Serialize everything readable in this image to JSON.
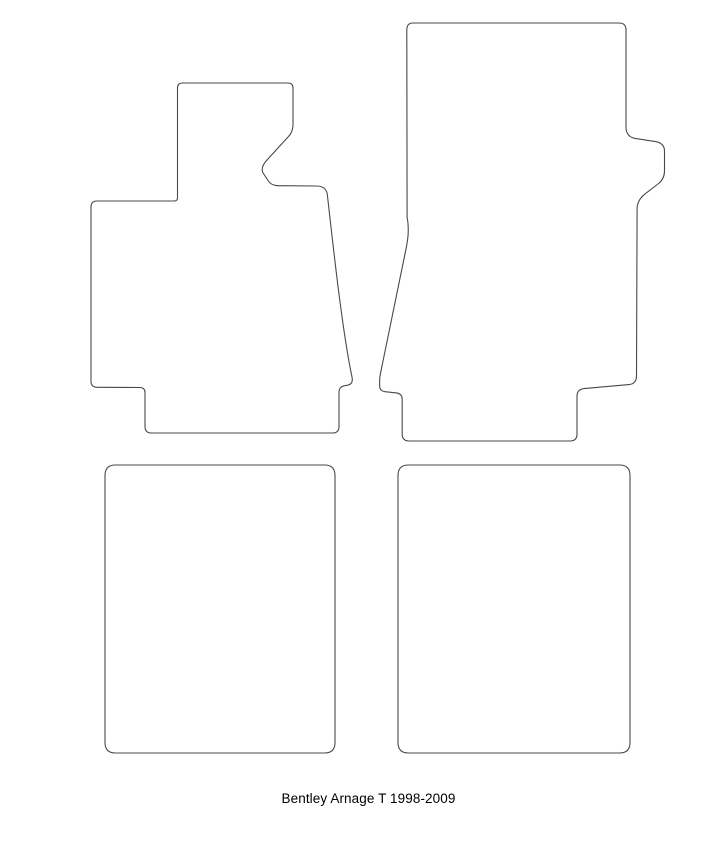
{
  "page": {
    "background_color": "#ffffff",
    "kind": "car floor mat template diagram"
  },
  "caption": {
    "text": "Bentley Arnage T 1998-2009",
    "color": "#000000"
  },
  "diagram": {
    "stroke_color": "#484848",
    "stroke_width": 1.1,
    "shapes": [
      {
        "name": "front-left-driver-mat-outline",
        "d": "M 182.5 83 L 288 83 Q 293 83 293 88 L 293 124 Q 293 132 288.5 136.5 L 267 160 Q 260.5 167 262.8 172.5 L 268 180.5 Q 271 185.5 278 185.7 L 317 186 Q 325.5 186.3 327.2 193.5 C 332.5 240 342 330 352 377 Q 353.5 384 347.5 385.2 L 344 385.8 Q 339 386.8 339 392.2 L 339 426.5 Q 339 433 332.5 433 L 151.5 433 Q 145 433 145 426.5 L 145 392.5 Q 145 387.8 140 387.5 L 97 387.3 Q 91 387.3 91 381.3 L 91 207 Q 91 201 97 201 L 174.5 201 Q 177.5 201 177.5 197.5 L 177.5 88 Q 177.5 83 182.5 83 Z"
      },
      {
        "name": "front-right-passenger-mat-outline",
        "d": "M 413 23 L 619 23 Q 626 23 626 30 L 626 128 Q 626.6 136.8 635 138.4 L 655.5 141.6 Q 664.5 143.2 664.5 151.2 L 664.5 171 Q 664.5 179 658 184 L 645.5 193.6 Q 637.2 200 637.1 208.5 L 636.5 376 Q 636.4 383.8 629 384.6 L 584 388.6 Q 577 389.4 577 396.4 L 577 434 Q 577 441 570 441 L 409.2 441 Q 402.2 441 402.2 434 L 402.2 399.4 Q 402.2 393.6 396.5 392.9 L 385 391.7 Q 379.6 391 379.6 385.6 L 379.6 381 Q 379.7 377 380.5 373.3 L 405.9 249.5 Q 407.9 239.8 408.2 233 Q 408.5 224 407.1 217.3 L 406.8 30 Q 406.8 23 413 23 Z"
      },
      {
        "name": "rear-left-mat-outline",
        "d": "M 115.5 465 L 324.5 465 Q 335 465 335 475.5 L 335 742.5 Q 335 753 324.5 753 L 115.5 753 Q 105 753 105 742.5 L 105 475.5 Q 105 465 115.5 465 Z"
      },
      {
        "name": "rear-right-mat-outline",
        "d": "M 408.5 465 L 619.5 465 Q 630 465 630 475.5 L 630 742.5 Q 630 753 619.5 753 L 408.5 753 Q 398 753 398 742.5 L 398 475.5 Q 398 465 408.5 465 Z"
      }
    ]
  }
}
